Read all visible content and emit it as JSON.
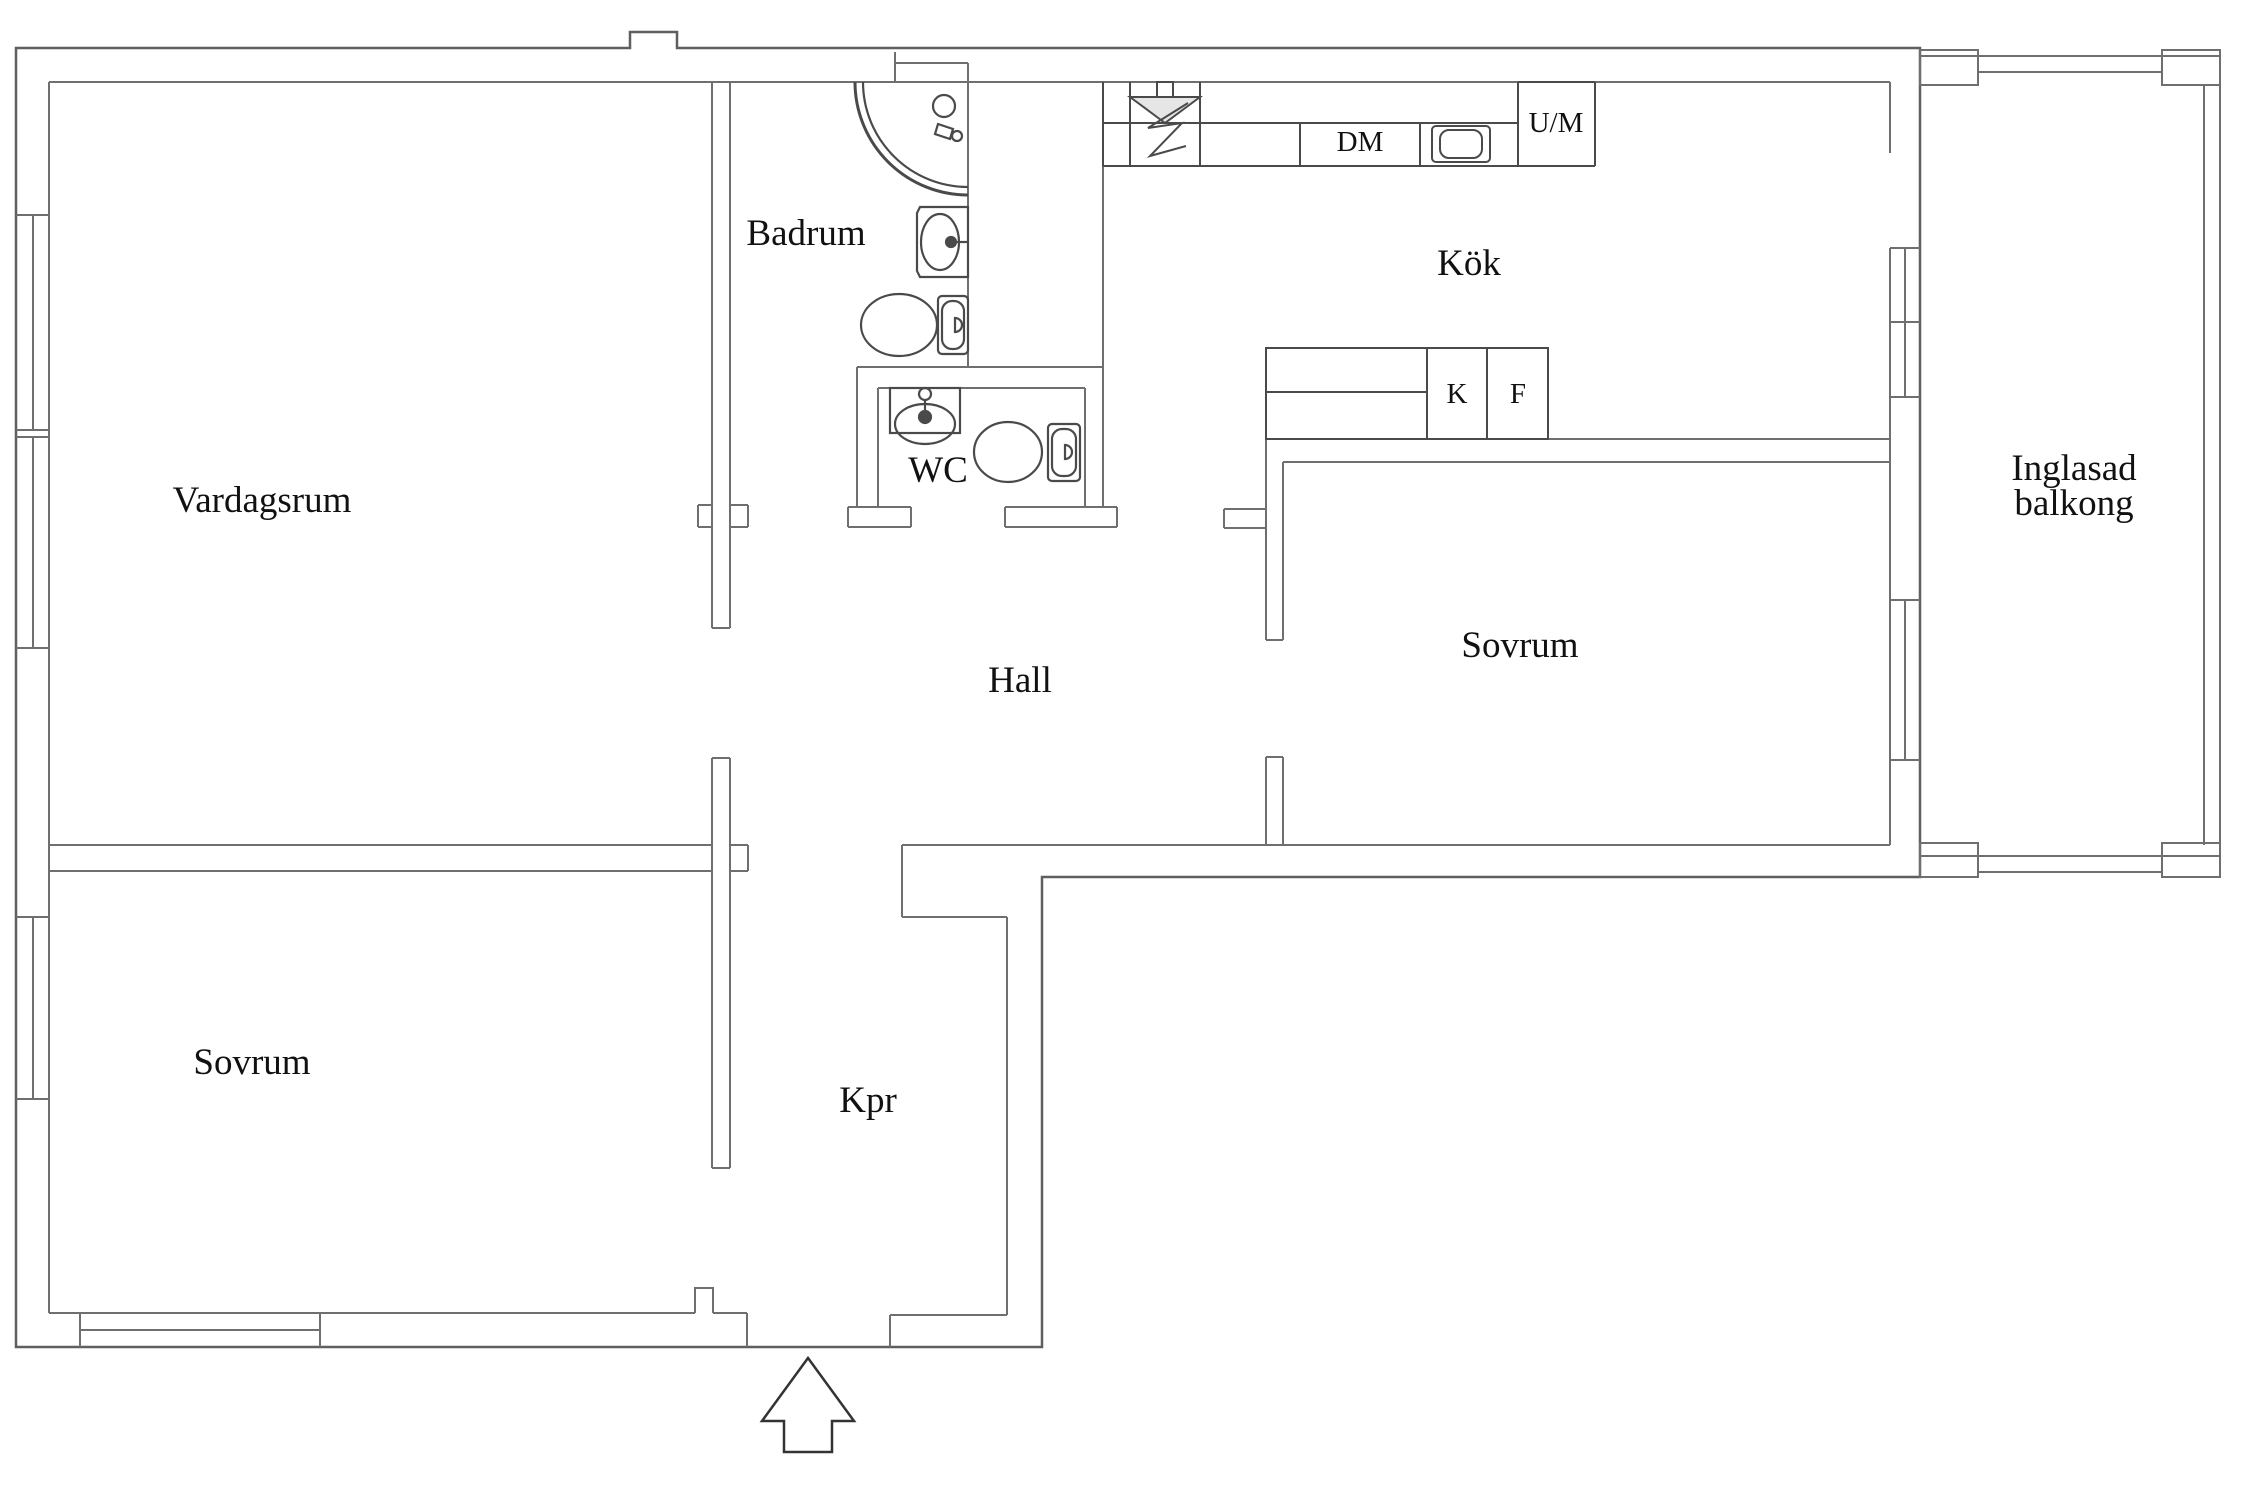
{
  "plan": {
    "type": "apartment-floor-plan",
    "language": "Swedish"
  },
  "colors": {
    "background": "#ffffff",
    "wall": "#6f6f6f",
    "wall_outer": "#5f5f5f",
    "fixture": "#4a4a4a",
    "hood_fill": "#e6e6e6",
    "text": "#111111",
    "arrow": "#333333"
  },
  "rooms": {
    "vardagsrum": {
      "label": "Vardagsrum"
    },
    "sovrum_left": {
      "label": "Sovrum"
    },
    "sovrum_right": {
      "label": "Sovrum"
    },
    "hall": {
      "label": "Hall"
    },
    "kpr": {
      "label": "Kpr"
    },
    "badrum": {
      "label": "Badrum"
    },
    "wc": {
      "label": "WC"
    },
    "kok": {
      "label": "Kök"
    },
    "balcony": {
      "line1": "Inglasad",
      "line2": "balkong"
    }
  },
  "appliances": {
    "dishwasher": "DM",
    "washer": "U/M",
    "fridge": "K",
    "freezer": "F"
  },
  "fixtures": [
    "corner-shower",
    "bathroom-washbasin",
    "bathroom-toilet",
    "wc-washbasin",
    "wc-toilet",
    "stove-hood",
    "kitchen-sink",
    "entrance-arrow",
    "windows",
    "kf-cabinet"
  ]
}
